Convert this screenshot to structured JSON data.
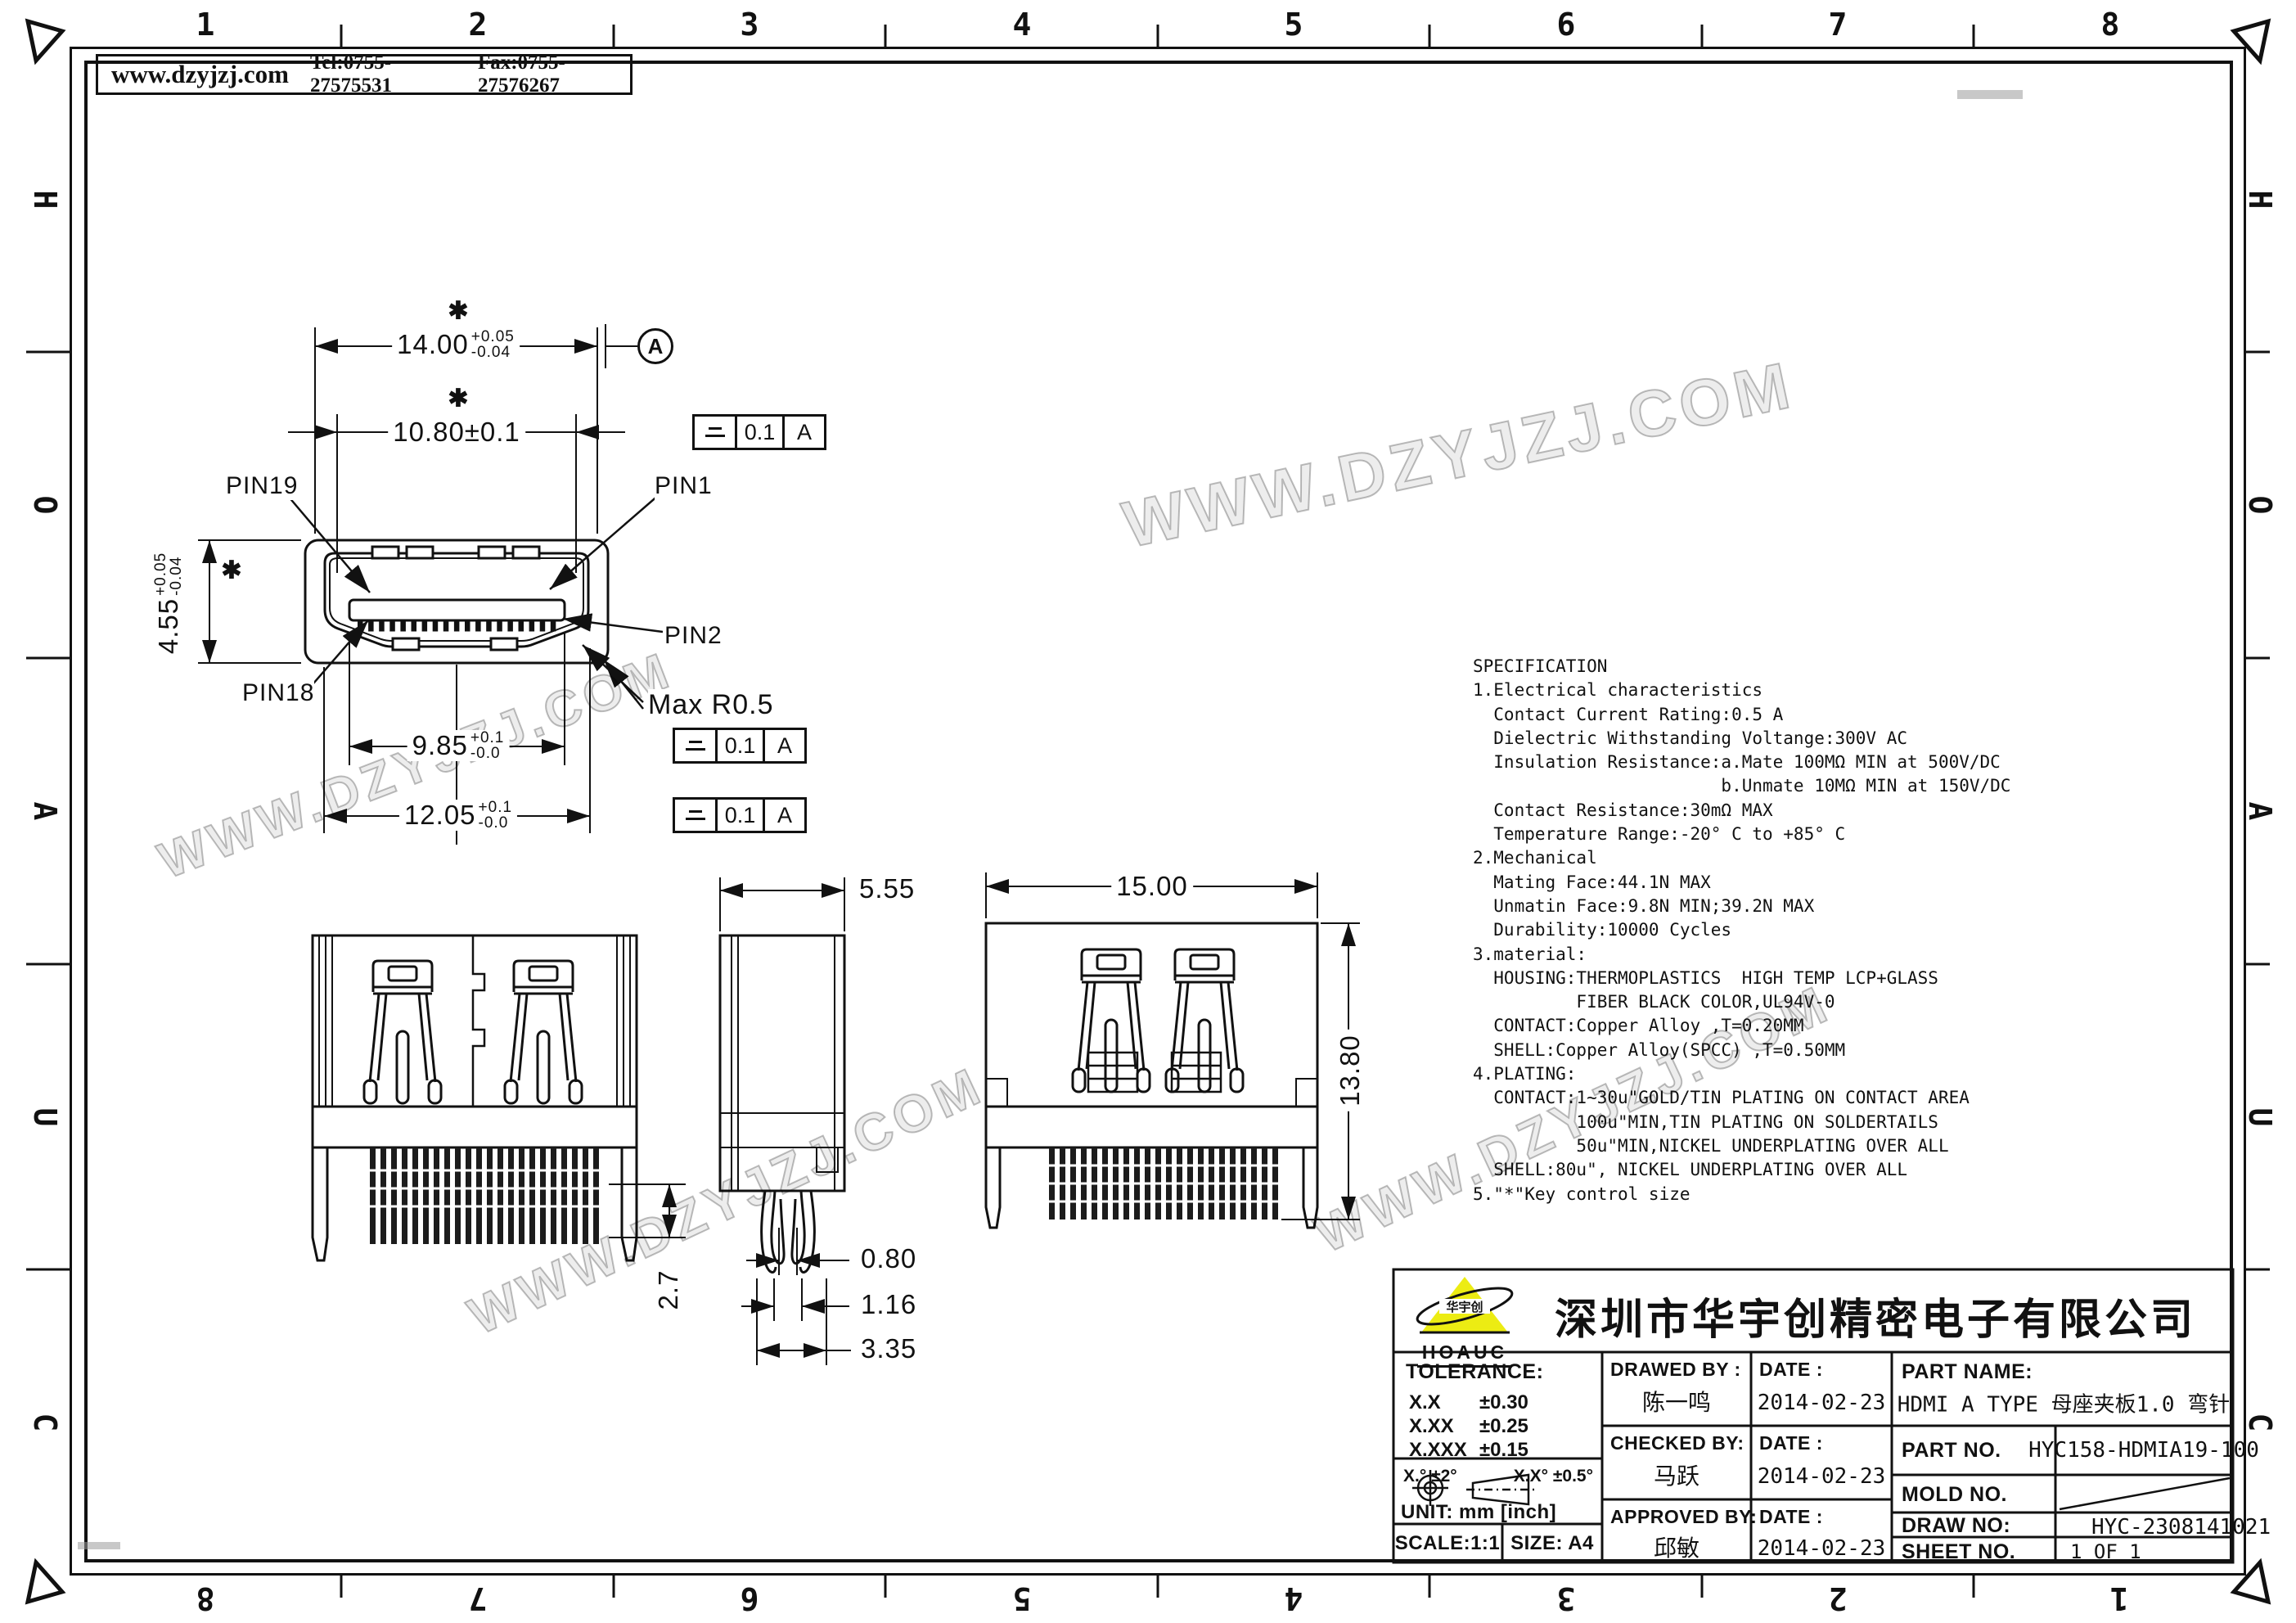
{
  "header": {
    "website": "www.dzyjzj.com",
    "tel": "Tel:0755-27575531",
    "fax": "Fax:0755-27576267"
  },
  "border": {
    "columns_top": [
      "1",
      "2",
      "3",
      "4",
      "5",
      "6",
      "7",
      "8"
    ],
    "columns_bottom": [
      "8",
      "7",
      "6",
      "5",
      "4",
      "3",
      "2",
      "1"
    ],
    "rows_left": [
      "H",
      "O",
      "A",
      "U",
      "C"
    ],
    "rows_right": [
      "H",
      "O",
      "A",
      "U",
      "C"
    ]
  },
  "watermark": {
    "text": "WWW.DZYJZJ.COM"
  },
  "face_view": {
    "dims": {
      "w_outer": {
        "v": "14.00",
        "tp": "+0.05",
        "tm": "-0.04"
      },
      "w_opening": {
        "v": "10.80±0.1"
      },
      "h_face": {
        "v": "4.55",
        "tp": "+0.05",
        "tm": "-0.04"
      },
      "w_tongue": {
        "v": "9.85",
        "tp": "+0.1",
        "tm": "-0.0"
      },
      "w_shroud": {
        "v": "12.05",
        "tp": "+0.1",
        "tm": "-0.0"
      },
      "key_mark": "✱"
    },
    "pins": {
      "pin19": "PIN19",
      "pin1": "PIN1",
      "pin2": "PIN2",
      "pin18": "PIN18"
    },
    "max_radius": "Max R0.5",
    "datum_label": "A",
    "fcf": {
      "symbol": "parallelism",
      "tolerance": "0.1",
      "datum": "A"
    }
  },
  "bottom_views": {
    "dims": {
      "side_w": "5.55",
      "rear_w": "15.00",
      "rear_h": "13.80",
      "tail_h": "2.7",
      "pin_w": "0.80",
      "pin_p": "1.16",
      "clamp_w": "3.35"
    }
  },
  "spec": {
    "text": "SPECIFICATION\n1.Electrical characteristics\n  Contact Current Rating:0.5 A\n  Dielectric Withstanding Voltange:300V AC\n  Insulation Resistance:a.Mate 100MΩ MIN at 500V/DC\n                        b.Unmate 10MΩ MIN at 150V/DC\n  Contact Resistance:30mΩ MAX\n  Temperature Range:-20° C to +85° C\n2.Mechanical\n  Mating Face:44.1N MAX\n  Unmatin Face:9.8N MIN;39.2N MAX\n  Durability:10000 Cycles\n3.material:\n  HOUSING:THERMOPLASTICS  HIGH TEMP LCP+GLASS\n          FIBER BLACK COLOR,UL94V-0\n  CONTACT:Copper Alloy ,T=0.20MM\n  SHELL:Copper Alloy(SPCC) ,T=0.50MM\n4.PLATING:\n  CONTACT:1~30u\"GOLD/TIN PLATING ON CONTACT AREA\n          100u\"MIN,TIN PLATING ON SOLDERTAILS\n          50u\"MIN,NICKEL UNDERPLATING OVER ALL\n  SHELL:80u\", NICKEL UNDERPLATING OVER ALL\n5.\"*\"Key control size"
  },
  "title_block": {
    "logo": {
      "brand": "HOAUC",
      "brand_cn": "华宇创",
      "accent": "#ecec13"
    },
    "company": "深圳市华宇创精密电子有限公司",
    "tolerance": {
      "title": "TOLERANCE:",
      "rows": [
        [
          "X.X",
          "±0.30"
        ],
        [
          "X.XX",
          "±0.25"
        ],
        [
          "X.XXX",
          "±0.15"
        ]
      ],
      "angle1": "X.°  ±2°",
      "angle2": "X.X°  ±0.5°"
    },
    "unit": "UNIT:  mm  [inch]",
    "scale": "SCALE:1:1",
    "size": "SIZE:  A4",
    "drawn": {
      "label": "DRAWED  BY :",
      "name": "陈一鸣",
      "date_label": "DATE :",
      "date": "2014-02-23"
    },
    "checked": {
      "label": "CHECKED  BY:",
      "name": "马跃",
      "date_label": "DATE :",
      "date": "2014-02-23"
    },
    "approved": {
      "label": "APPROVED  BY:",
      "name": "邱敏",
      "date_label": "DATE :",
      "date": "2014-02-23"
    },
    "part_name": {
      "label": "PART  NAME:",
      "value": "HDMI A TYPE 母座夹板1.0 弯针"
    },
    "part_no": {
      "label": "PART  NO.",
      "value": "HYC158-HDMIA19-100"
    },
    "mold_no": {
      "label": "MOLD  NO.",
      "value": ""
    },
    "draw_no": {
      "label": "DRAW  NO:",
      "value": "HYC-2308141021"
    },
    "sheet_no": {
      "label": "SHEET  NO.",
      "value": "1 OF 1"
    }
  }
}
